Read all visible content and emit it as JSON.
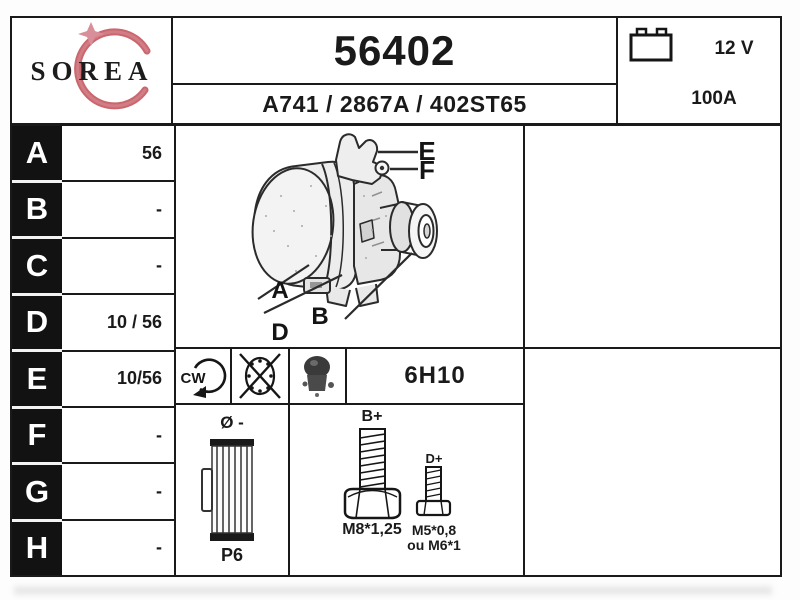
{
  "logo": {
    "name": "SOREA",
    "swoosh_color": "#c4565e",
    "star_color": "#d98f99"
  },
  "header": {
    "part_number": "56402",
    "reference_line": "A741 / 2867A / 402ST65"
  },
  "battery": {
    "voltage": "12 V",
    "amperage": "100A"
  },
  "spec_rows": [
    {
      "letter": "A",
      "value": "56"
    },
    {
      "letter": "B",
      "value": "-"
    },
    {
      "letter": "C",
      "value": "-"
    },
    {
      "letter": "D",
      "value": "10 / 56"
    },
    {
      "letter": "E",
      "value": "10/56"
    },
    {
      "letter": "F",
      "value": "-"
    },
    {
      "letter": "G",
      "value": "-"
    },
    {
      "letter": "H",
      "value": "-"
    }
  ],
  "drawing": {
    "callout_e": "E",
    "callout_f": "F",
    "callout_a": "A",
    "callout_b": "B",
    "callout_d": "D"
  },
  "icons_row": {
    "rotation": "CW",
    "housing_code": "6H10"
  },
  "pulley": {
    "diameter": "Ø -",
    "type": "P6"
  },
  "bolts": {
    "b_label": "B+",
    "b_thread": "M8*1,25",
    "d_label": "D+",
    "d_thread": "M5*0,8",
    "d_thread_alt": "ou M6*1"
  }
}
